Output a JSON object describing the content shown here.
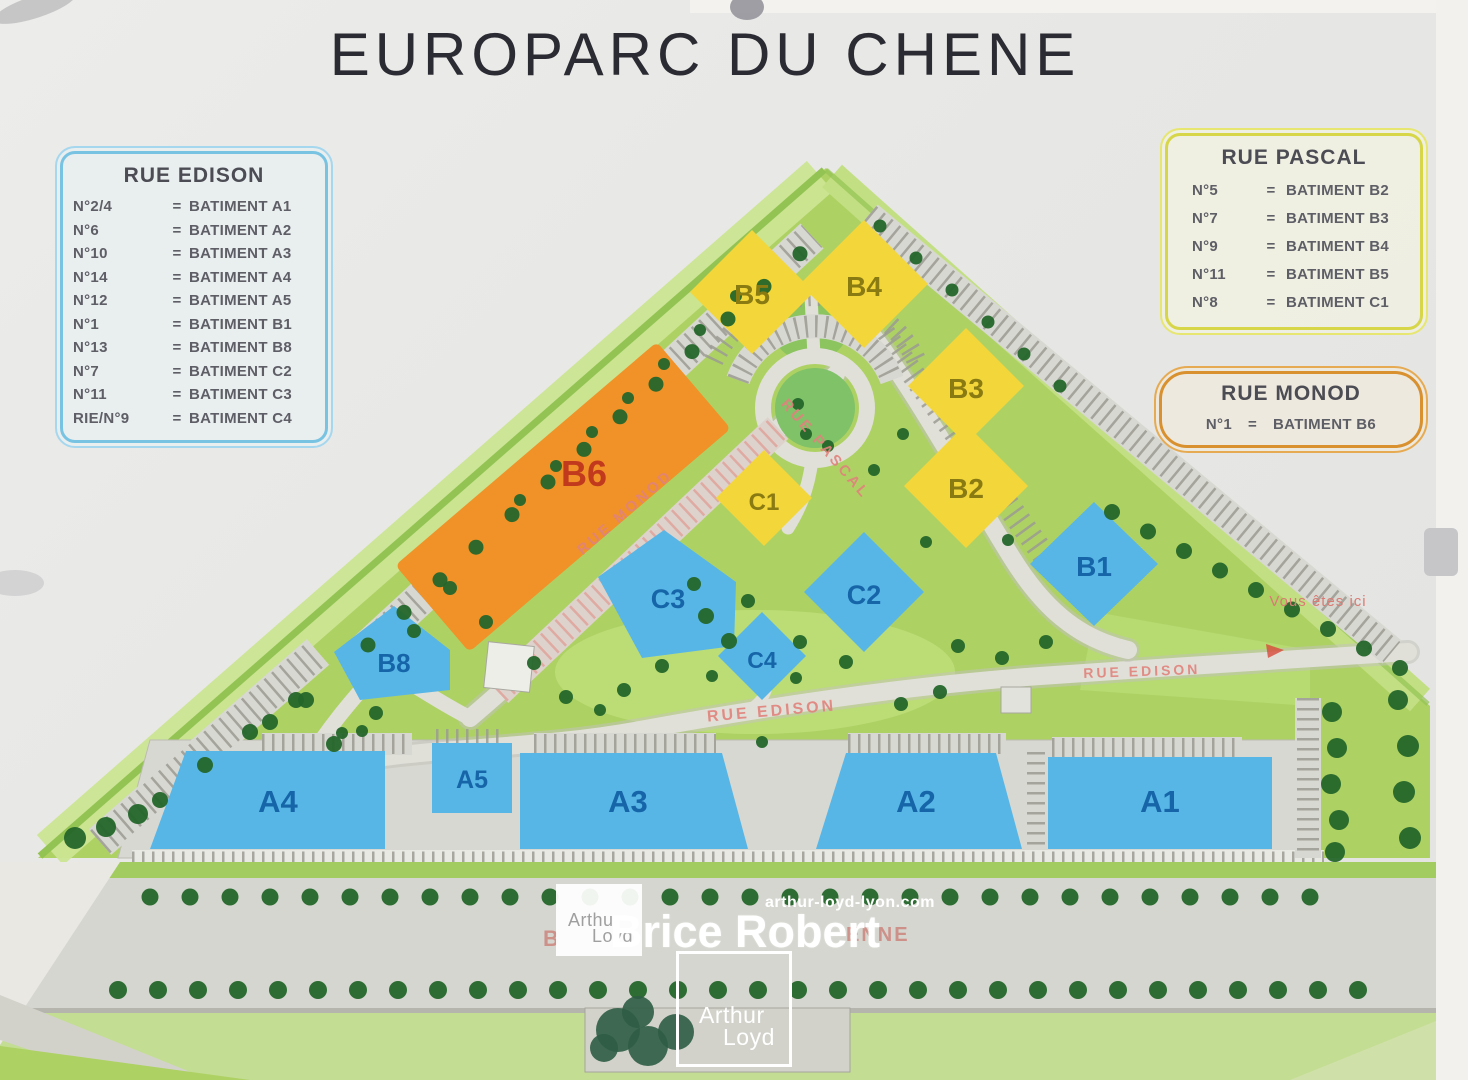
{
  "title": "EUROPARC DU CHENE",
  "legends": {
    "edison": {
      "title": "RUE EDISON",
      "rows": [
        {
          "no": "N°2/4",
          "eq": "=",
          "bat": "BATIMENT A1"
        },
        {
          "no": "N°6",
          "eq": "=",
          "bat": "BATIMENT A2"
        },
        {
          "no": "N°10",
          "eq": "=",
          "bat": "BATIMENT A3"
        },
        {
          "no": "N°14",
          "eq": "=",
          "bat": "BATIMENT A4"
        },
        {
          "no": "N°12",
          "eq": "=",
          "bat": "BATIMENT A5"
        },
        {
          "no": "N°1",
          "eq": "=",
          "bat": "BATIMENT B1"
        },
        {
          "no": "N°13",
          "eq": "=",
          "bat": "BATIMENT B8"
        },
        {
          "no": "N°7",
          "eq": "=",
          "bat": "BATIMENT C2"
        },
        {
          "no": "N°11",
          "eq": "=",
          "bat": "BATIMENT C3"
        },
        {
          "no": "RIE/N°9",
          "eq": "=",
          "bat": "BATIMENT C4"
        }
      ]
    },
    "pascal": {
      "title": "RUE PASCAL",
      "rows": [
        {
          "no": "N°5",
          "eq": "=",
          "bat": "BATIMENT B2"
        },
        {
          "no": "N°7",
          "eq": "=",
          "bat": "BATIMENT B3"
        },
        {
          "no": "N°9",
          "eq": "=",
          "bat": "BATIMENT B4"
        },
        {
          "no": "N°11",
          "eq": "=",
          "bat": "BATIMENT B5"
        },
        {
          "no": "N°8",
          "eq": "=",
          "bat": "BATIMENT C1"
        }
      ]
    },
    "monod": {
      "title": "RUE MONOD",
      "rows": [
        {
          "no": "N°1",
          "eq": "=",
          "bat": "BATIMENT B6"
        }
      ]
    }
  },
  "map": {
    "buildings": {
      "a1": "A1",
      "a2": "A2",
      "a3": "A3",
      "a4": "A4",
      "a5": "A5",
      "b1": "B1",
      "b2": "B2",
      "b3": "B3",
      "b4": "B4",
      "b5": "B5",
      "b6": "B6",
      "b8": "B8",
      "c1": "C1",
      "c2": "C2",
      "c3": "C3",
      "c4": "C4"
    },
    "street_labels": {
      "monod": "RUE MONOD",
      "pascal": "RUE PASCAL",
      "edison_center": "RUE EDISON",
      "edison_east": "RUE EDISON"
    },
    "you_are_here": "Vous êtes ici",
    "boulevard_fragments": {
      "left": "B",
      "right": "ENNE"
    }
  },
  "watermarks": {
    "site_url": "arthur-loyd-lyon.com",
    "agent": "Brice Robert",
    "logo": {
      "line1": "Arthur",
      "line2": "Loyd"
    }
  },
  "colors": {
    "site_green": "#aed164",
    "road_grey": "#d8d8d2",
    "building_blue": "#58b6e6",
    "building_yellow": "#f2d63a",
    "building_orange": "#f09228",
    "street_label_red": "#e0837c",
    "tree_green": "#24662a",
    "legend_blue": "#79c3e2",
    "legend_yellow": "#d6d648",
    "legend_orange": "#d9912f"
  }
}
